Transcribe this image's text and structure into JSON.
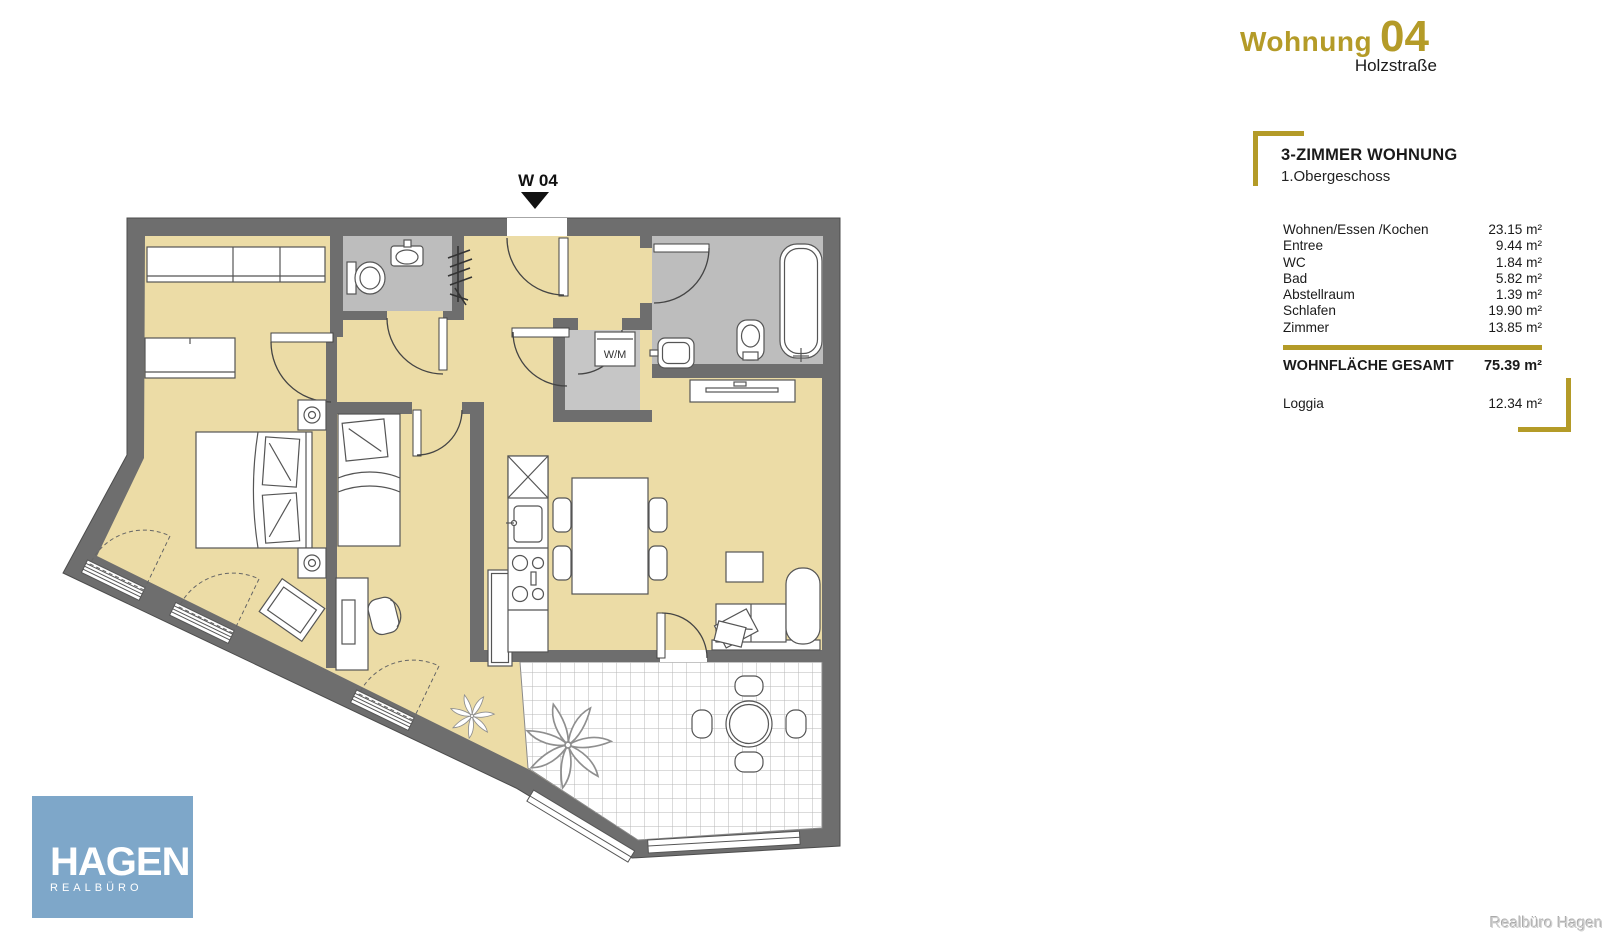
{
  "header": {
    "title_word": "Wohnung",
    "title_number": "04",
    "street": "Holzstraße"
  },
  "apartment": {
    "type_heading": "3-ZIMMER WOHNUNG",
    "floor": "1.Obergeschoss"
  },
  "area_table": {
    "rows": [
      {
        "label": "Wohnen/Essen /Kochen",
        "area": "23.15 m²"
      },
      {
        "label": "Entree",
        "area": "9.44 m²"
      },
      {
        "label": "WC",
        "area": "1.84 m²"
      },
      {
        "label": "Bad",
        "area": "5.82 m²"
      },
      {
        "label": "Abstellraum",
        "area": "1.39 m²"
      },
      {
        "label": "Schlafen",
        "area": "19.90 m²"
      },
      {
        "label": "Zimmer",
        "area": "13.85 m²"
      }
    ],
    "total": {
      "label": "WOHNFLÄCHE GESAMT",
      "area": "75.39 m²"
    },
    "loggia": {
      "label": "Loggia",
      "area": "12.34 m²"
    }
  },
  "plan": {
    "unit_label": "W 04",
    "washer_label": "W/M"
  },
  "logo": {
    "main": "HAGEN",
    "sub": "REALBÜRO"
  },
  "credit": "Realbüro Hagen",
  "colors": {
    "accent_gold": "#b49b28",
    "wall_gray": "#6e6e6e",
    "floor_beige": "#ecdca6",
    "wet_room_gray": "#bdbdbd",
    "logo_blue": "#7ea7c9",
    "marker_black": "#111111"
  }
}
